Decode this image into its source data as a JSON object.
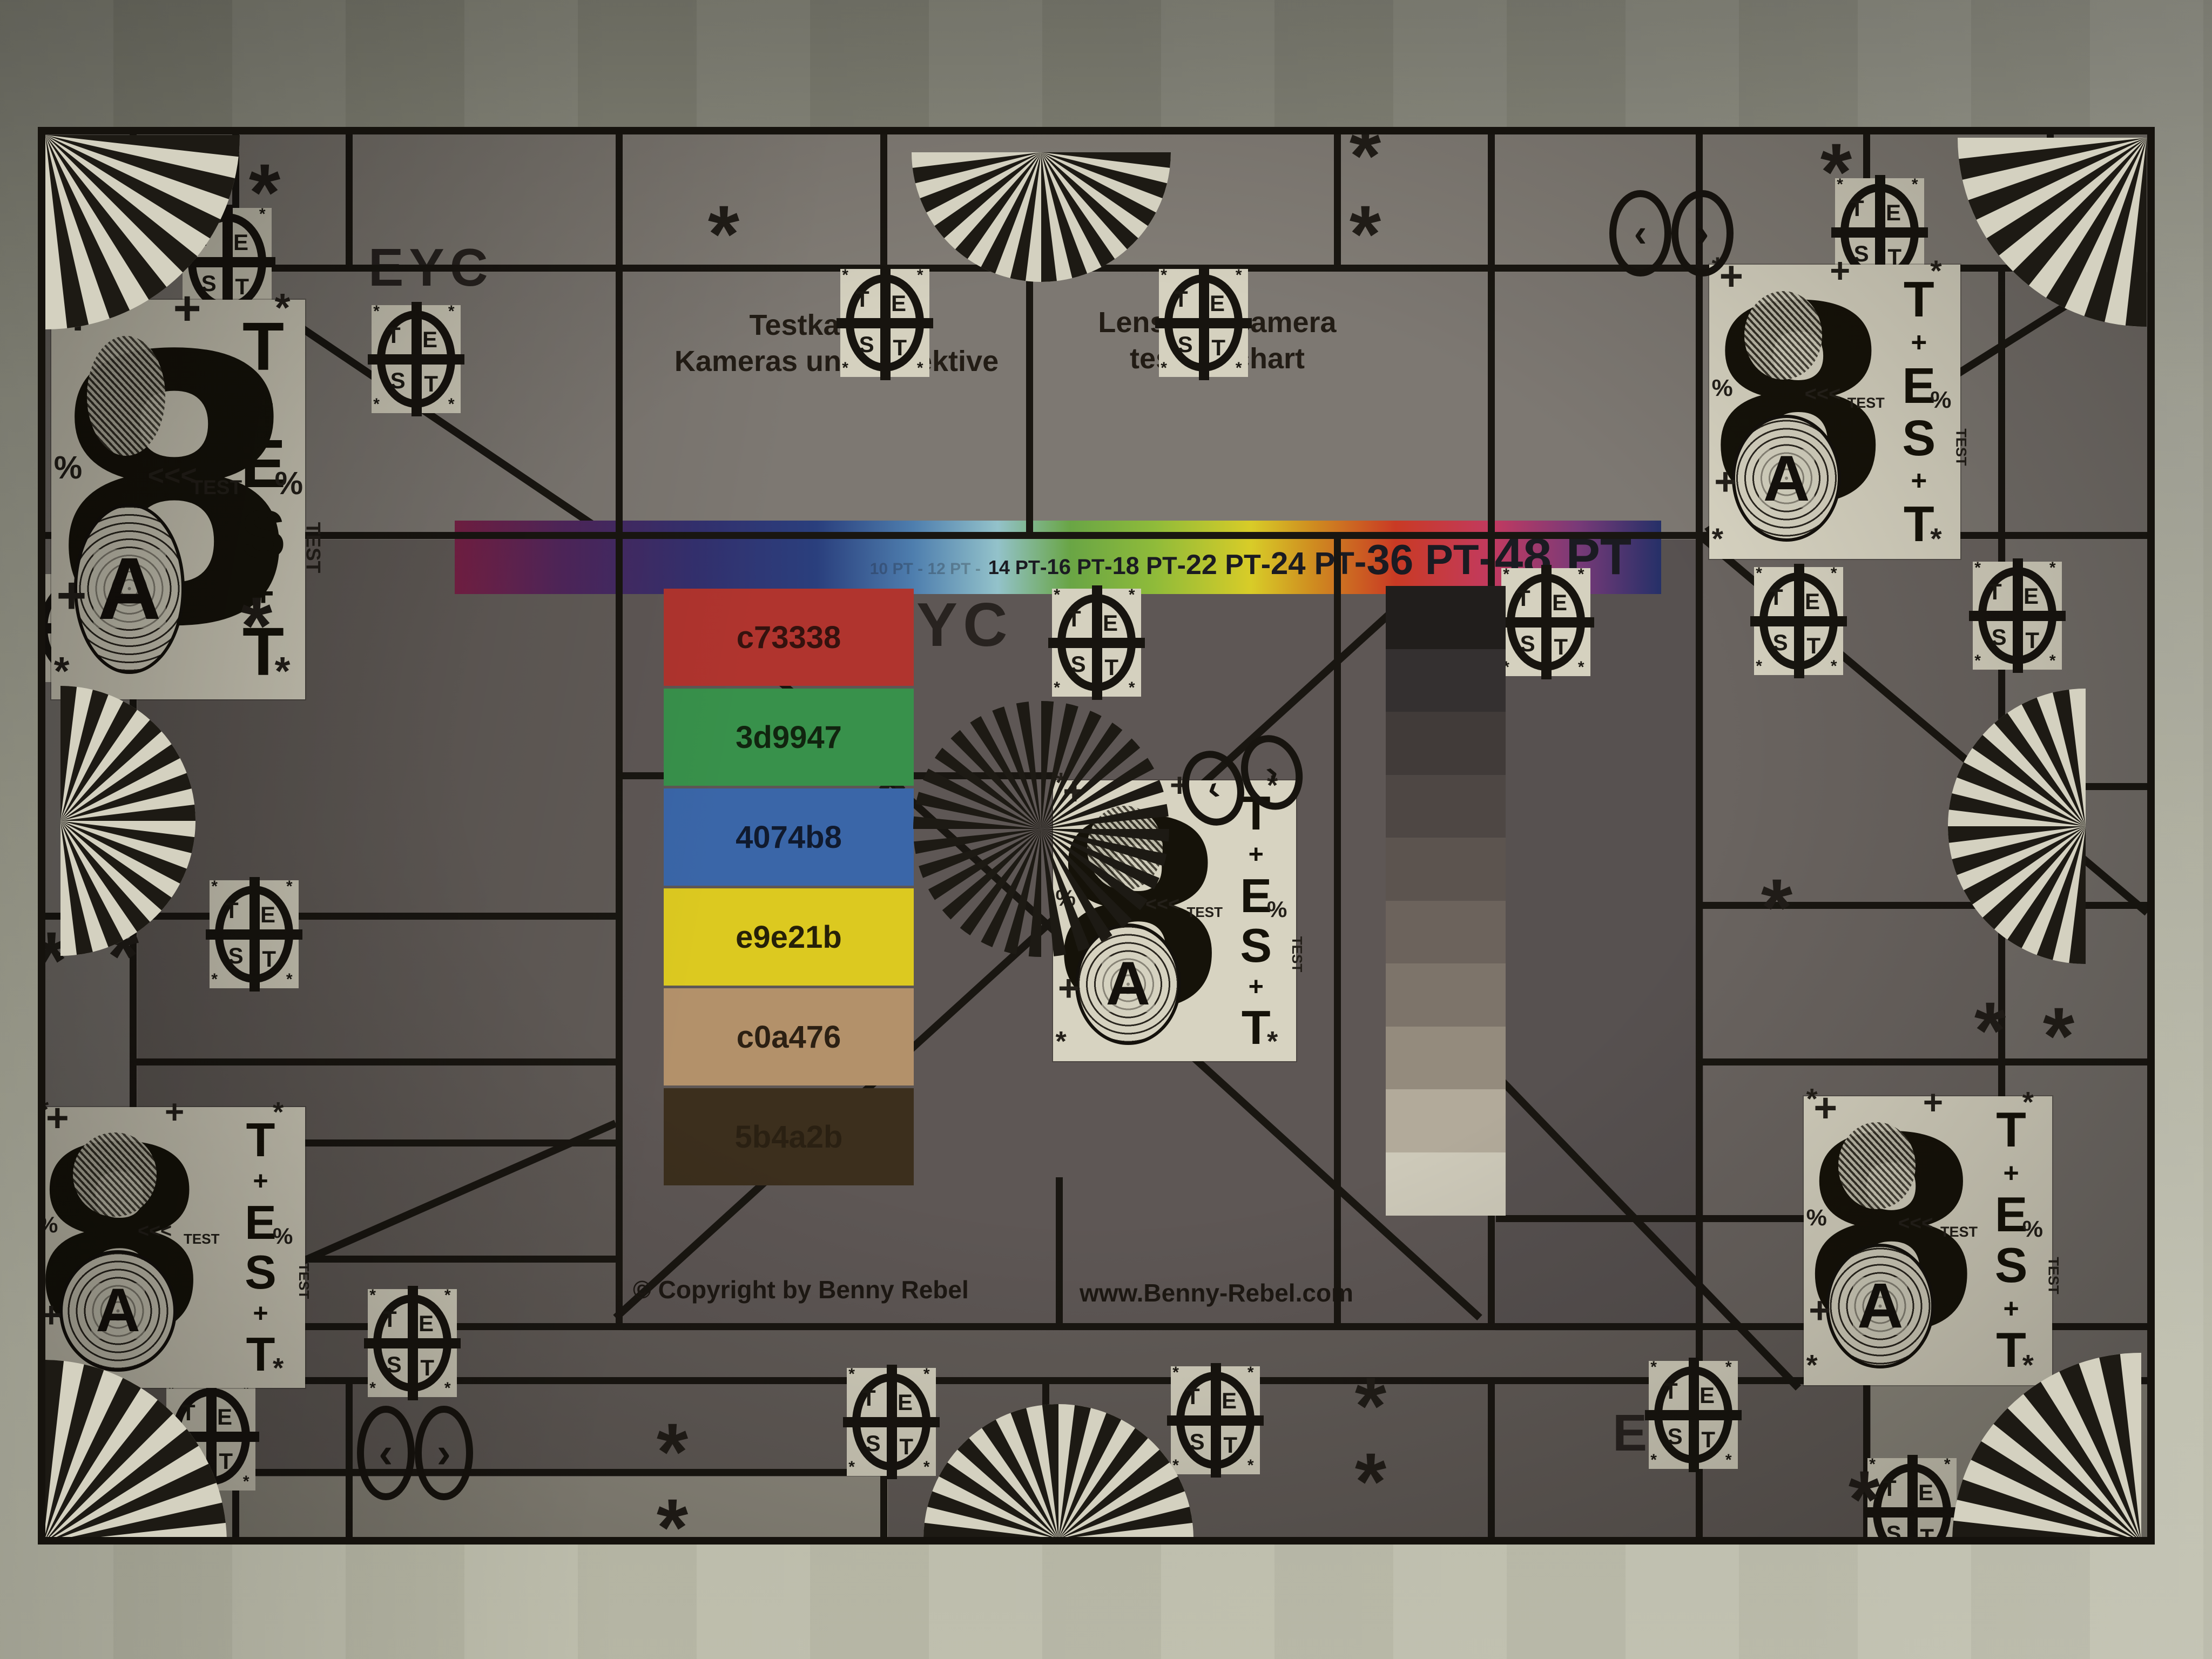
{
  "scene": "Photograph of a physical lens and camera test chart taped to a wall, underexposed",
  "eyc": {
    "top_left": "EYC",
    "center": "EYC",
    "bottom_right": "EYC"
  },
  "header": {
    "title_de_line1": "Testkarte für",
    "title_de_line2": "Kameras und Objektive",
    "title_en_line1": "Lens and camera",
    "title_en_line2": "testing chart"
  },
  "pt_scale": {
    "faint_prefix": "10 PT - 12 PT",
    "labels": [
      "14 PT",
      "16 PT",
      "18 PT",
      "22 PT",
      "24 PT",
      "36 PT",
      "48 PT"
    ],
    "separator": "-"
  },
  "color_patches": [
    {
      "label": "c73338",
      "color": "#b0342e",
      "label_color": "#34120e"
    },
    {
      "label": "3d9947",
      "color": "#38914b",
      "label_color": "#11240f"
    },
    {
      "label": "4074b8",
      "color": "#3a66a8",
      "label_color": "#101a2e"
    },
    {
      "label": "e9e21b",
      "color": "#dcc920",
      "label_color": "#262008"
    },
    {
      "label": "c0a476",
      "color": "#b3916a",
      "label_color": "#2c2013"
    },
    {
      "label": "5b4a2b",
      "color": "#3c2f1d",
      "label_color": "#1c140a"
    }
  ],
  "grayscale_steps": [
    "#211e1c",
    "#343030",
    "#413b39",
    "#4e4744",
    "#5c544f",
    "#6c635c",
    "#7d746a",
    "#948b7d",
    "#b2aa9a",
    "#cdc9b9"
  ],
  "footer": {
    "copyright": "© Copyright by Benny Rebel",
    "website": "www.Benny-Rebel.com"
  },
  "glyphs": {
    "big_digit": "8",
    "ring_letter": "A",
    "test_word": "TEST",
    "marker_letters": [
      "T",
      "E",
      "S",
      "T"
    ],
    "asterisk": "*",
    "plus": "+",
    "percent": "%",
    "arrows": "<<<"
  },
  "palette": {
    "paper_cream": "#d6d2c0",
    "ink_black": "#17140f",
    "chart_gray": "#625c58",
    "wall_green_gray": "#b4b4a2"
  }
}
